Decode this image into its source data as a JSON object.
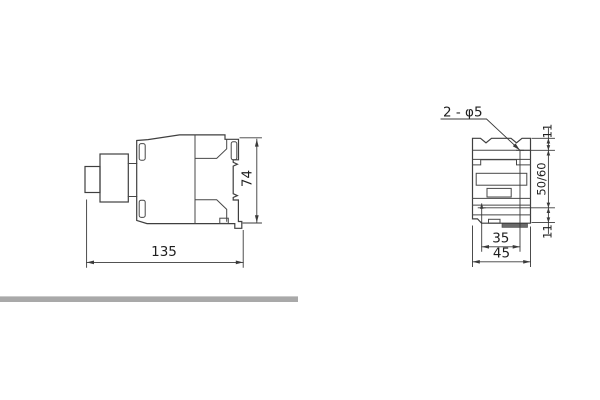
{
  "side_view": {
    "length_label": "135",
    "height_label": "74"
  },
  "front_view": {
    "holes_label": "2 - φ5",
    "hole_pitch_x_label": "35",
    "width_label": "45",
    "top_offset_label": "11",
    "hole_pitch_y_label": "50/60",
    "bottom_offset_label": "11"
  },
  "colors": {
    "line": "#3f3f3f",
    "dimension": "#3a3a3a",
    "text": "#1f1f1f",
    "divider_bar": "#a9a9a9",
    "clip_bar": "#6a6a6a",
    "background": "#ffffff"
  }
}
